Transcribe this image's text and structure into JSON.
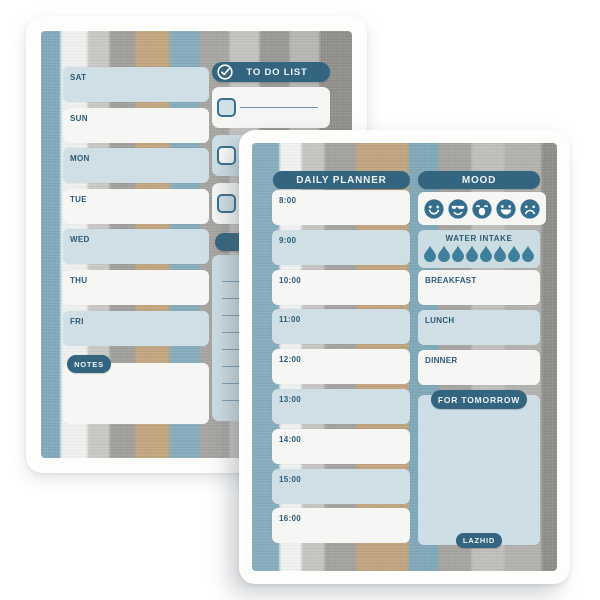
{
  "colors": {
    "accent_teal": "#346580",
    "text_dark": "#2b5a75",
    "box_blue": "#cfdfe5",
    "box_white": "#f6f7f5",
    "drop_teal": "#3f7f9b",
    "emoji_teal": "#346f8d"
  },
  "back_page": {
    "weekly": {
      "days": [
        "SAT",
        "SUN",
        "MON",
        "TUE",
        "WED",
        "THU",
        "FRI"
      ],
      "notes_label": "NOTES"
    },
    "todo": {
      "title": "TO DO LIST",
      "rows": 3
    },
    "shopping": {
      "title_visible": "SHO",
      "lines": 8
    }
  },
  "front_page": {
    "daily": {
      "title": "DAILY PLANNER",
      "times": [
        "8:00",
        "9:00",
        "10:00",
        "11:00",
        "12:00",
        "13:00",
        "14:00",
        "15:00",
        "16:00"
      ]
    },
    "mood": {
      "title": "MOOD",
      "icons": [
        "happy-face-icon",
        "cool-face-icon",
        "yawning-face-icon",
        "grinning-face-icon",
        "sad-face-icon"
      ]
    },
    "water": {
      "title": "WATER INTAKE",
      "drops": 8
    },
    "meals": [
      "BREAKFAST",
      "LUNCH",
      "DINNER"
    ],
    "tomorrow": {
      "title": "FOR TOMORROW"
    },
    "brand": "LAZHID"
  }
}
